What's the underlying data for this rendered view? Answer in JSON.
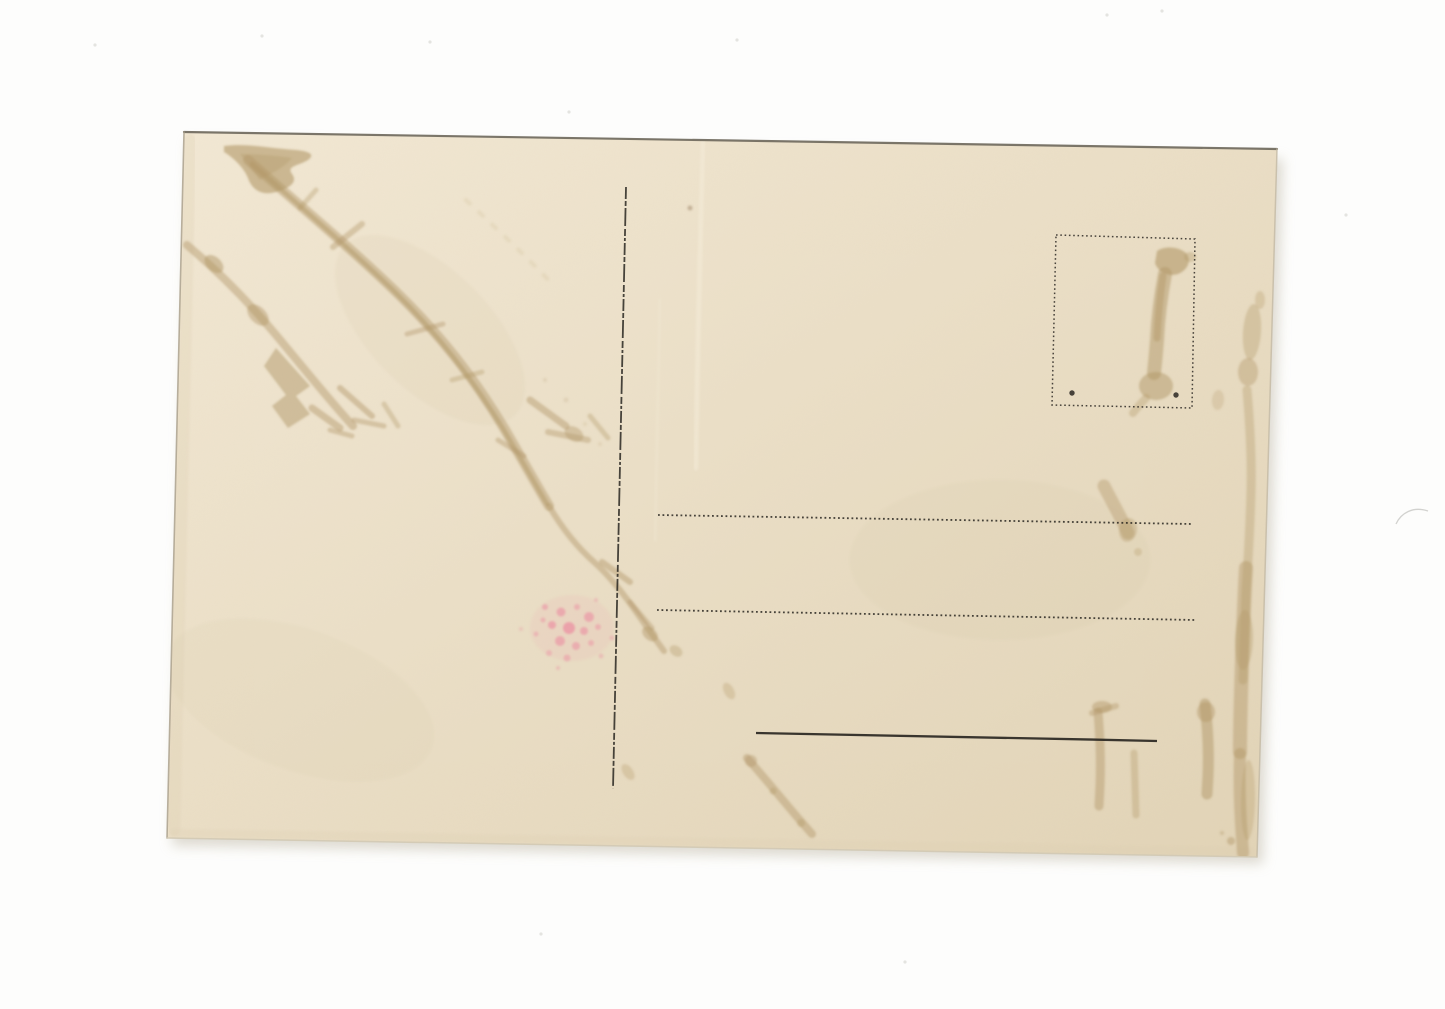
{
  "photo": {
    "background": "#fdfdfc",
    "speck_color": "#e4e4e0",
    "shadow_color": "#d8d4c9",
    "specks": [
      [
        95,
        45
      ],
      [
        262,
        36
      ],
      [
        430,
        42
      ],
      [
        569,
        112
      ],
      [
        737,
        40
      ],
      [
        1107,
        15
      ],
      [
        1162,
        11
      ],
      [
        1346,
        215
      ],
      [
        905,
        962
      ],
      [
        541,
        934
      ]
    ],
    "hair_mark": {
      "d": "M1396,524 C1401,513 1413,506 1428,511",
      "color": "#b5b5b0",
      "w": 1.3,
      "o": 0.6
    }
  },
  "postcard": {
    "corners": "184,132 1277,149 1257,857 167,838",
    "paper": {
      "light": "#f2e8d4",
      "mid": "#ebdfc7",
      "dark": "#e2d4b7"
    },
    "ink": "#2a2722",
    "stain": "#b29768",
    "pink": "#ec7f9b",
    "edges": [
      {
        "name": "card-edge-top",
        "d": "M184,132 L1277,149",
        "color": "#6d675b",
        "w": 2.2,
        "o": 0.9
      },
      {
        "name": "card-edge-left",
        "d": "M184,132 L167,838",
        "color": "#a79d8a",
        "w": 1.6,
        "o": 0.8
      },
      {
        "name": "card-edge-right",
        "d": "M1277,149 L1257,857",
        "color": "#c3b9a4",
        "w": 1.5,
        "o": 0.8
      },
      {
        "name": "card-edge-bottom",
        "d": "M167,838 L1257,857",
        "color": "#d2c9b4",
        "w": 1.5,
        "o": 0.9
      }
    ],
    "shading": [
      {
        "d": "M190,140 L174,830",
        "color": "#dccdb0",
        "w": 12,
        "o": 0.25
      },
      {
        "d": "M175,833 L1250,852",
        "color": "#dccdb0",
        "w": 8,
        "o": 0.2
      },
      {
        "d": "M703,142 C700,250 697,360 696,468",
        "color": "#f4ecd9",
        "w": 5,
        "o": 0.5
      },
      {
        "d": "M660,300 C658,380 656,460 655,540",
        "color": "#f2ead6",
        "w": 3,
        "o": 0.3
      }
    ],
    "printed": [
      {
        "kind": "line",
        "name": "divider-line",
        "x1": 626,
        "y1": 187,
        "x2": 613,
        "y2": 789,
        "w": 1.8,
        "dash": "12 2 5 2 18 3 7 2 3 2",
        "o": 0.85
      },
      {
        "kind": "line",
        "name": "address-line-1",
        "x1": 658,
        "y1": 515,
        "x2": 1192,
        "y2": 524,
        "w": 1.8,
        "dash": "1.8 2.7",
        "o": 0.85
      },
      {
        "kind": "line",
        "name": "address-line-2",
        "x1": 657,
        "y1": 610,
        "x2": 1195,
        "y2": 620,
        "w": 1.8,
        "dash": "1.8 2.7",
        "o": 0.85
      },
      {
        "kind": "path",
        "name": "signature-line",
        "d": "M756,733 C880,735 1020,738 1157,741",
        "w": 2.3,
        "dash": "",
        "o": 0.92
      },
      {
        "kind": "poly",
        "name": "stamp-box-border",
        "points": "1056,235 1195,239 1192,408 1052,405",
        "w": 1.5,
        "dash": "1.6 2.7",
        "o": 0.85
      },
      {
        "kind": "dot",
        "name": "stamp-box-dot-left",
        "cx": 1072,
        "cy": 393,
        "r": 2.7,
        "o": 0.85
      },
      {
        "kind": "dot",
        "name": "stamp-box-dot-right",
        "cx": 1176,
        "cy": 395,
        "r": 2.7,
        "o": 0.85
      }
    ],
    "stains": [
      {
        "kind": "ellipse",
        "cx": 430,
        "cy": 330,
        "rx": 120,
        "ry": 60,
        "rot": 45,
        "o": 0.1,
        "color": "#cdb990"
      },
      {
        "kind": "ellipse",
        "cx": 1000,
        "cy": 560,
        "rx": 150,
        "ry": 80,
        "rot": 0,
        "o": 0.07,
        "color": "#cdb990"
      },
      {
        "kind": "ellipse",
        "cx": 300,
        "cy": 700,
        "rx": 140,
        "ry": 70,
        "rot": 20,
        "o": 0.07,
        "color": "#cdb990"
      },
      {
        "kind": "fill",
        "d": "M224,146 C246,143 268,148 296,150 C308,151 316,154 308,160 C298,166 286,166 292,174 C298,182 290,188 276,192 C262,196 252,190 248,178 C244,168 234,158 224,152 Z",
        "o": 0.6
      },
      {
        "kind": "fill",
        "d": "M240,154 C258,154 280,156 292,158 C284,168 270,174 260,180 C252,170 246,162 240,154 Z",
        "o": 0.35
      },
      {
        "kind": "path",
        "d": "M248,160 C300,206 346,244 392,288 C440,334 474,378 504,428 C518,452 533,479 549,506",
        "w": 10,
        "o": 0.45
      },
      {
        "kind": "path",
        "d": "M252,164 C302,208 348,247 393,290 C439,335 472,379 502,427 C516,450 531,477 547,504",
        "w": 4.5,
        "o": 0.5
      },
      {
        "kind": "path",
        "d": "M333,247 L362,224",
        "w": 6,
        "o": 0.4
      },
      {
        "kind": "path",
        "d": "M300,208 L316,190",
        "w": 5,
        "o": 0.35
      },
      {
        "kind": "path",
        "d": "M407,334 L443,324",
        "w": 5,
        "o": 0.4
      },
      {
        "kind": "path",
        "d": "M452,380 L482,372",
        "w": 5,
        "o": 0.35
      },
      {
        "kind": "path",
        "d": "M498,440 L524,456",
        "w": 5,
        "o": 0.4
      },
      {
        "kind": "path",
        "d": "M187,245 C226,278 254,308 286,347 C306,371 331,402 353,426",
        "w": 8,
        "o": 0.45
      },
      {
        "kind": "ellipse",
        "cx": 214,
        "cy": 264,
        "rx": 11,
        "ry": 7,
        "rot": 42,
        "o": 0.5
      },
      {
        "kind": "ellipse",
        "cx": 258,
        "cy": 315,
        "rx": 13,
        "ry": 8,
        "rot": 45,
        "o": 0.45
      },
      {
        "kind": "fill",
        "d": "M276,348 L310,386 L296,396 L310,414 L288,428 L272,406 L286,395 L264,366 Z",
        "o": 0.5
      },
      {
        "kind": "path",
        "d": "M312,408 L340,428",
        "w": 7,
        "o": 0.45
      },
      {
        "kind": "path",
        "d": "M330,430 L352,436",
        "w": 5,
        "o": 0.4
      },
      {
        "kind": "path",
        "d": "M340,388 L372,416",
        "w": 6,
        "o": 0.45
      },
      {
        "kind": "path",
        "d": "M354,420 L384,426",
        "w": 5,
        "o": 0.4
      },
      {
        "kind": "path",
        "d": "M384,404 L398,426",
        "w": 5,
        "o": 0.35
      },
      {
        "kind": "path",
        "d": "M530,400 L566,426",
        "w": 7,
        "o": 0.45
      },
      {
        "kind": "path",
        "d": "M548,432 L588,440",
        "w": 6,
        "o": 0.4
      },
      {
        "kind": "path",
        "d": "M590,416 L608,438",
        "w": 5,
        "o": 0.35
      },
      {
        "kind": "ellipse",
        "cx": 574,
        "cy": 434,
        "rx": 10,
        "ry": 7,
        "rot": 30,
        "o": 0.4
      },
      {
        "kind": "path",
        "d": "M549,506 C562,528 577,547 594,562 C612,578 629,601 646,626 C653,636 659,644 664,651",
        "w": 6,
        "o": 0.45
      },
      {
        "kind": "path",
        "d": "M602,562 L630,582",
        "w": 6,
        "o": 0.45
      },
      {
        "kind": "path",
        "d": "M630,602 L652,628",
        "w": 5,
        "o": 0.4
      },
      {
        "kind": "ellipse",
        "cx": 650,
        "cy": 634,
        "rx": 9,
        "ry": 6,
        "rot": 40,
        "o": 0.45
      },
      {
        "kind": "ellipse",
        "cx": 676,
        "cy": 651,
        "rx": 7,
        "ry": 5,
        "rot": 35,
        "o": 0.35
      },
      {
        "kind": "ellipse",
        "cx": 628,
        "cy": 772,
        "rx": 9,
        "ry": 5,
        "rot": 55,
        "o": 0.3
      },
      {
        "kind": "path",
        "d": "M747,758 C763,776 781,798 798,818 L812,834",
        "w": 8,
        "o": 0.45
      },
      {
        "kind": "dot",
        "cx": 751,
        "cy": 761,
        "r": 6,
        "o": 0.4
      },
      {
        "kind": "dot",
        "cx": 773,
        "cy": 791,
        "r": 3.5,
        "o": 0.35
      },
      {
        "kind": "dot",
        "cx": 801,
        "cy": 823,
        "r": 4,
        "o": 0.35
      },
      {
        "kind": "ellipse",
        "cx": 729,
        "cy": 691,
        "rx": 9,
        "ry": 5,
        "rot": 62,
        "o": 0.3
      },
      {
        "kind": "ellipse",
        "name": "pink-stain-haze",
        "cx": 572,
        "cy": 628,
        "rx": 42,
        "ry": 33,
        "rot": 0,
        "o": 0.1,
        "color": "#ef8fa6"
      },
      {
        "kind": "fill",
        "d": "M1157,251 C1164,246 1178,246 1186,253 C1192,260 1188,270 1178,274 C1168,277 1158,272 1155,263 Z",
        "o": 0.6
      },
      {
        "kind": "path",
        "d": "M1165,274 C1161,295 1158,318 1157,340 C1156,354 1155,364 1154,373",
        "w": 14,
        "o": 0.5
      },
      {
        "kind": "path",
        "d": "M1163,276 C1160,296 1158,318 1157,338",
        "w": 7,
        "o": 0.45
      },
      {
        "kind": "ellipse",
        "cx": 1156,
        "cy": 386,
        "rx": 17,
        "ry": 14,
        "rot": 0,
        "o": 0.5
      },
      {
        "kind": "path",
        "d": "M1146,398 C1140,404 1136,409 1133,413",
        "w": 8,
        "o": 0.35
      },
      {
        "kind": "ellipse",
        "cx": 1190,
        "cy": 257,
        "rx": 6,
        "ry": 5,
        "rot": 0,
        "o": 0.35
      },
      {
        "kind": "ellipse",
        "cx": 1252,
        "cy": 332,
        "rx": 9,
        "ry": 28,
        "rot": 4,
        "o": 0.35
      },
      {
        "kind": "ellipse",
        "cx": 1248,
        "cy": 372,
        "rx": 10,
        "ry": 14,
        "rot": 0,
        "o": 0.4
      },
      {
        "kind": "ellipse",
        "cx": 1260,
        "cy": 300,
        "rx": 5,
        "ry": 9,
        "rot": 0,
        "o": 0.3
      },
      {
        "kind": "ellipse",
        "cx": 1218,
        "cy": 400,
        "rx": 6,
        "ry": 10,
        "rot": 5,
        "o": 0.25
      },
      {
        "kind": "path",
        "d": "M1247,390 C1250,425 1252,458 1251,492 C1250,530 1248,562 1246,592 C1245,622 1244,652 1243,680",
        "w": 9,
        "o": 0.35
      },
      {
        "kind": "path",
        "d": "M1246,568 C1244,602 1243,632 1242,662 C1241,692 1240,722 1240,752",
        "w": 14,
        "o": 0.45
      },
      {
        "kind": "ellipse",
        "cx": 1244,
        "cy": 640,
        "rx": 9,
        "ry": 30,
        "rot": 2,
        "o": 0.35
      },
      {
        "kind": "path",
        "d": "M1240,754 C1239,782 1240,812 1242,838 L1243,853",
        "w": 12,
        "o": 0.45
      },
      {
        "kind": "ellipse",
        "cx": 1248,
        "cy": 800,
        "rx": 7,
        "ry": 40,
        "rot": 1,
        "o": 0.3
      },
      {
        "kind": "path",
        "d": "M1104,486 C1112,502 1121,517 1128,533",
        "w": 13,
        "o": 0.4
      },
      {
        "kind": "ellipse",
        "cx": 1128,
        "cy": 530,
        "rx": 9,
        "ry": 12,
        "rot": 10,
        "o": 0.35
      },
      {
        "kind": "dot",
        "cx": 1138,
        "cy": 552,
        "r": 4,
        "o": 0.3
      },
      {
        "kind": "path",
        "d": "M1098,712 C1100,736 1101,762 1100,786 L1099,806",
        "w": 9,
        "o": 0.45
      },
      {
        "kind": "path",
        "d": "M1092,713 L1116,706",
        "w": 6,
        "o": 0.4
      },
      {
        "kind": "ellipse",
        "cx": 1102,
        "cy": 707,
        "rx": 10,
        "ry": 6,
        "rot": 0,
        "o": 0.45
      },
      {
        "kind": "path",
        "d": "M1134,753 L1136,815",
        "w": 7,
        "o": 0.35
      },
      {
        "kind": "path",
        "d": "M1205,704 C1208,730 1209,754 1208,776 L1207,794",
        "w": 11,
        "o": 0.5
      },
      {
        "kind": "ellipse",
        "cx": 1206,
        "cy": 712,
        "rx": 9,
        "ry": 10,
        "rot": 0,
        "o": 0.45
      },
      {
        "kind": "dot",
        "cx": 1231,
        "cy": 841,
        "r": 4,
        "o": 0.45
      },
      {
        "kind": "dot",
        "cx": 1222,
        "cy": 833,
        "r": 2,
        "o": 0.35
      },
      {
        "kind": "path",
        "d": "M466,200 C498,230 528,258 556,288",
        "w": 4,
        "o": 0.13,
        "dash": "5 13"
      },
      {
        "kind": "dot",
        "cx": 545,
        "cy": 380,
        "r": 2,
        "o": 0.18
      },
      {
        "kind": "dot",
        "cx": 566,
        "cy": 400,
        "r": 2.5,
        "o": 0.18
      },
      {
        "kind": "dot",
        "cx": 585,
        "cy": 424,
        "r": 2,
        "o": 0.15
      },
      {
        "kind": "dot",
        "cx": 600,
        "cy": 444,
        "r": 2,
        "o": 0.15
      },
      {
        "kind": "dot",
        "cx": 690,
        "cy": 208,
        "r": 2.5,
        "o": 0.4,
        "color": "#8a6f4e"
      }
    ],
    "pink_speckles": [
      [
        545,
        607,
        3,
        0.45
      ],
      [
        561,
        612,
        4.5,
        0.5
      ],
      [
        577,
        607,
        3,
        0.4
      ],
      [
        589,
        617,
        5,
        0.5
      ],
      [
        552,
        625,
        4,
        0.55
      ],
      [
        569,
        628,
        6,
        0.6
      ],
      [
        584,
        631,
        4,
        0.5
      ],
      [
        598,
        627,
        3,
        0.4
      ],
      [
        560,
        641,
        5,
        0.5
      ],
      [
        576,
        646,
        4,
        0.45
      ],
      [
        591,
        643,
        3,
        0.4
      ],
      [
        549,
        653,
        3,
        0.35
      ],
      [
        567,
        658,
        3.5,
        0.4
      ],
      [
        601,
        656,
        2.5,
        0.3
      ],
      [
        612,
        638,
        2.5,
        0.3
      ],
      [
        536,
        634,
        2.5,
        0.35
      ],
      [
        558,
        668,
        2,
        0.3
      ],
      [
        596,
        600,
        2,
        0.3
      ],
      [
        521,
        629,
        2,
        0.25
      ],
      [
        543,
        620,
        2.5,
        0.4
      ]
    ]
  }
}
